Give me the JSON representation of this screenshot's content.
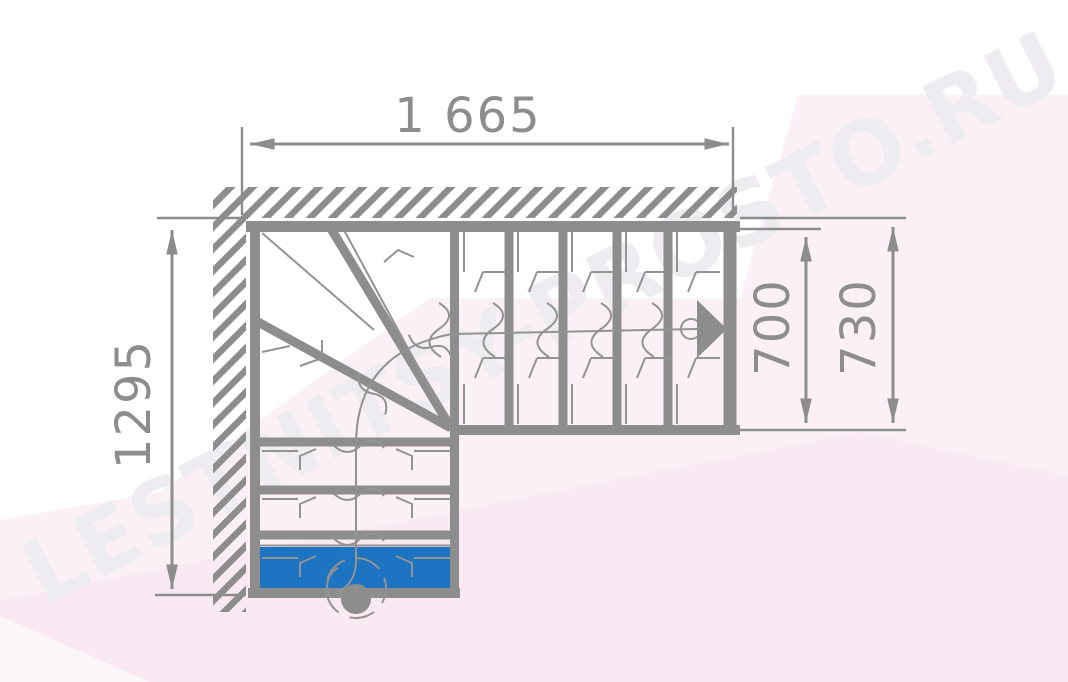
{
  "drawing": {
    "kind": "L-shaped staircase floor plan with winder steps",
    "watermark_text": "LESTNITSY-PROSTO.RU",
    "dimensions": {
      "total_width": "1 665",
      "total_depth": "1295",
      "flight_clear_width": "700",
      "flight_overall_width": "730"
    },
    "icons": {
      "direction_arrow": "walk-line direction arrow pointing right",
      "newel_post": "round newel post at first step"
    },
    "colors": {
      "line_gray": "#8d8d8d",
      "thin_gray": "#939393",
      "step_blue": "#1d74c2",
      "tint_light": "#fcf0f7",
      "tint_deep": "#f5e4ee",
      "watermark_gray": "#efecf1",
      "paper_white": "#ffffff"
    }
  }
}
